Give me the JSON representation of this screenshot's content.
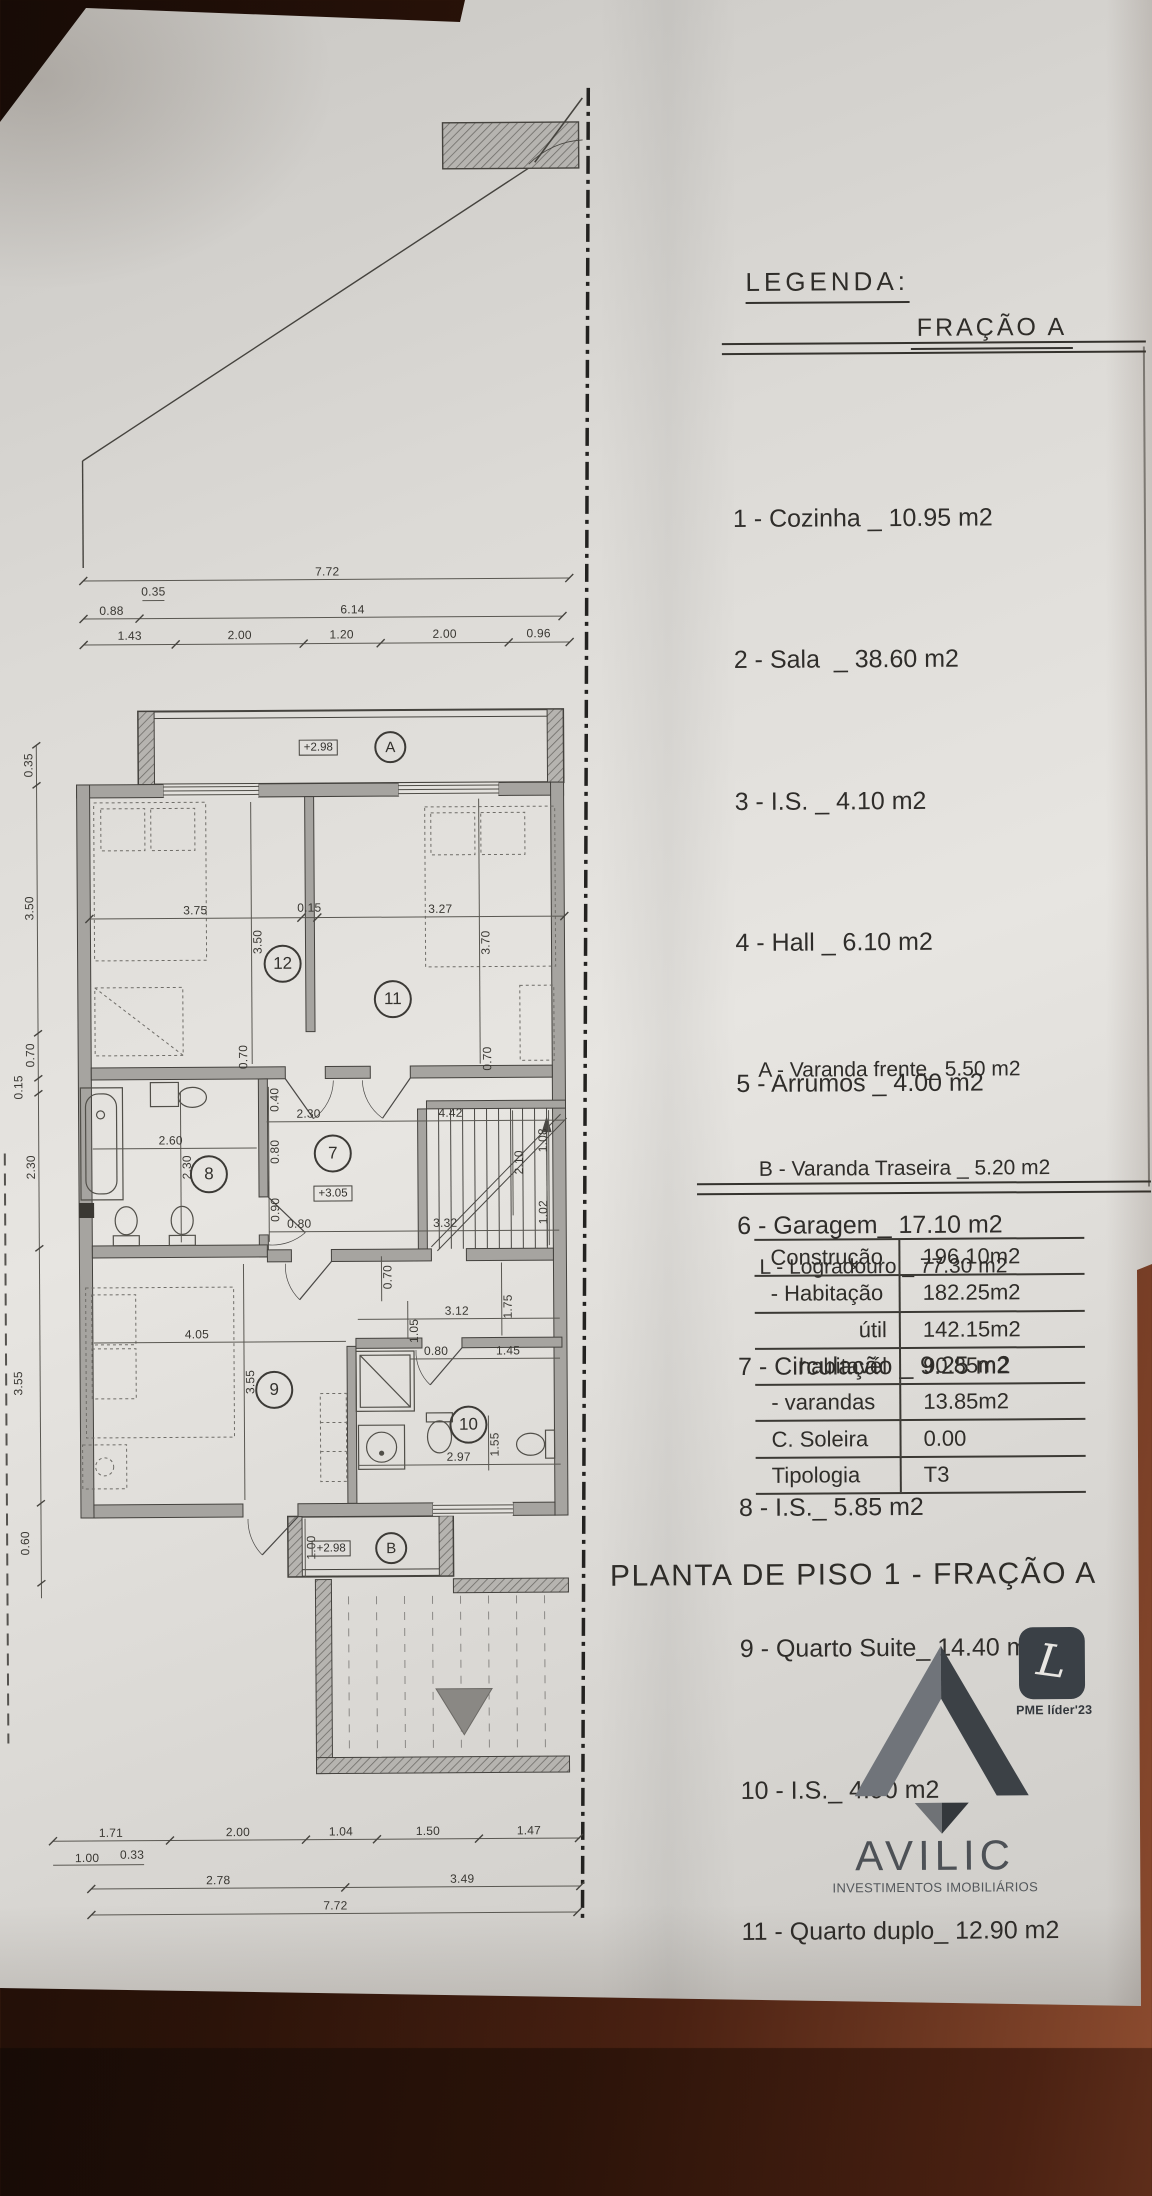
{
  "legend": {
    "title": "LEGENDA:",
    "fraction_label": "FRAÇÃO A",
    "items": [
      "1 - Cozinha _ 10.95 m2",
      "2 - Sala  _ 38.60 m2",
      "3 - I.S. _ 4.10 m2",
      "4 - Hall _ 6.10 m2",
      "5 - Arrumos _ 4.00 m2",
      "6 - Garagem_ 17.10 m2",
      "7 - Circulação _ 9.25 m2",
      "8 - I.S._ 5.85 m2",
      "9 - Quarto Suite_ 14.40 m2",
      "10 - I.S._ 4.90 m2",
      "11 - Quarto duplo_ 12.90 m2",
      "12 - Quarto duplo_ 14.00 m2"
    ],
    "annex_items": [
      "A - Varanda frente_ 5.50 m2",
      "B - Varanda Traseira _ 5.20 m2",
      "L - Logradouro _ 77.30 m2"
    ]
  },
  "areas_table": {
    "rows": [
      {
        "label": "Construção",
        "value": "196.10m2"
      },
      {
        "label": "- Habitação",
        "value": "182.25m2"
      },
      {
        "label": "útil",
        "value": "142.15m2"
      },
      {
        "label": "habitavél",
        "value": "90.85m2"
      },
      {
        "label": "- varandas",
        "value": "13.85m2"
      },
      {
        "label": "C. Soleira",
        "value": "0.00"
      },
      {
        "label": "Tipologia",
        "value": "T3"
      }
    ]
  },
  "sheet_title": "PLANTA DE PISO 1 - FRAÇÃO A",
  "logo": {
    "name": "AVILIC",
    "tagline": "INVESTIMENTOS IMOBILIÁRIOS",
    "badge_letter": "L",
    "badge_label": "PME líder'23"
  },
  "plan": {
    "room_numbers": {
      "r12": "12",
      "r11": "11",
      "r8": "8",
      "r7": "7",
      "r9": "9",
      "r10": "10"
    },
    "balcony_letters": {
      "front": "A",
      "rear": "B"
    },
    "levels": {
      "balcony_a": "+2.98",
      "corridor": "+3.05",
      "balcony_b": "+2.98"
    },
    "dims": {
      "top_total": "7.72",
      "t035": "0.35",
      "t088": "0.88",
      "t614": "6.14",
      "t143": "1.43",
      "t200a": "2.00",
      "t120": "1.20",
      "t200b": "2.00",
      "t096": "0.96",
      "l035": "0.35",
      "l350": "3.50",
      "l070": "0.70",
      "l015": "0.15",
      "l230": "2.30",
      "l355": "3.55",
      "l060": "0.60",
      "b171": "1.71",
      "b200": "2.00",
      "b104": "1.04",
      "b150": "1.50",
      "b147": "1.47",
      "b100": "1.00",
      "b033": "0.33",
      "b278": "2.78",
      "b349": "3.49",
      "bottom_total": "7.72",
      "i375": "3.75",
      "i015": "0.15",
      "i327": "3.27",
      "i350": "3.50",
      "i370": "3.70",
      "i070a": "0.70",
      "i070b": "0.70",
      "i230a": "2.30",
      "i442": "4.42",
      "i040": "0.40",
      "i260": "2.60",
      "i230b": "2.30",
      "i080a": "0.80",
      "i210": "2.10",
      "i108": "1.08",
      "i090": "0.90",
      "i080b": "0.80",
      "i332": "3.32",
      "i102": "1.02",
      "i070c": "0.70",
      "i312": "3.12",
      "i175": "1.75",
      "i105": "1.05",
      "i405": "4.05",
      "i080c": "0.80",
      "i145": "1.45",
      "i355b": "3.55",
      "i297": "2.97",
      "i155": "1.55",
      "i100": "1.00"
    }
  }
}
